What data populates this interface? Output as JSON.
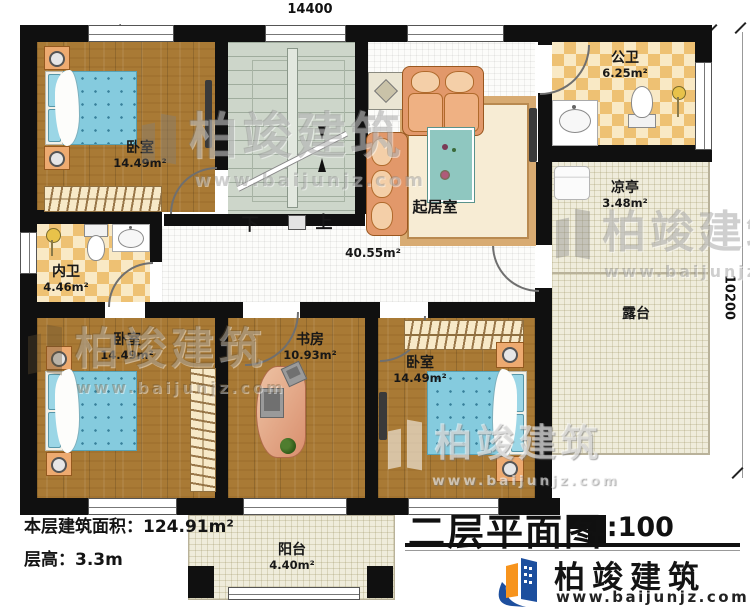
{
  "plan": {
    "dim_top": "14400",
    "dim_right": "10200",
    "title": {
      "text": "二层平面图",
      "scale": "1:100"
    },
    "stats": {
      "floor_area": "本层建筑面积：124.91m²",
      "floor_height": "层高：3.3m"
    },
    "stairs": {
      "down": "下",
      "up": "上"
    },
    "rooms": {
      "bedroom_tl": {
        "name": "卧室",
        "area": "14.49m²"
      },
      "bathroom_public": {
        "name": "公卫",
        "area": "6.25m²"
      },
      "pavilion": {
        "name": "凉亭",
        "area": "3.48m²"
      },
      "living": {
        "name": "起居室",
        "area": "40.55m²"
      },
      "bathroom_inner": {
        "name": "内卫",
        "area": "4.46m²"
      },
      "bedroom_bl": {
        "name": "卧室",
        "area": "14.49m²"
      },
      "study": {
        "name": "书房",
        "area": "10.93m²"
      },
      "bedroom_br": {
        "name": "卧室",
        "area": "14.49m²"
      },
      "terrace": {
        "name": "露台"
      },
      "balcony": {
        "name": "阳台",
        "area": "4.40m²"
      }
    },
    "watermark": {
      "brand": "柏竣建筑",
      "url": "www.baijunjz.com"
    },
    "logo": {
      "brand": "柏竣建筑",
      "url": "www.baijunjz.com"
    }
  }
}
